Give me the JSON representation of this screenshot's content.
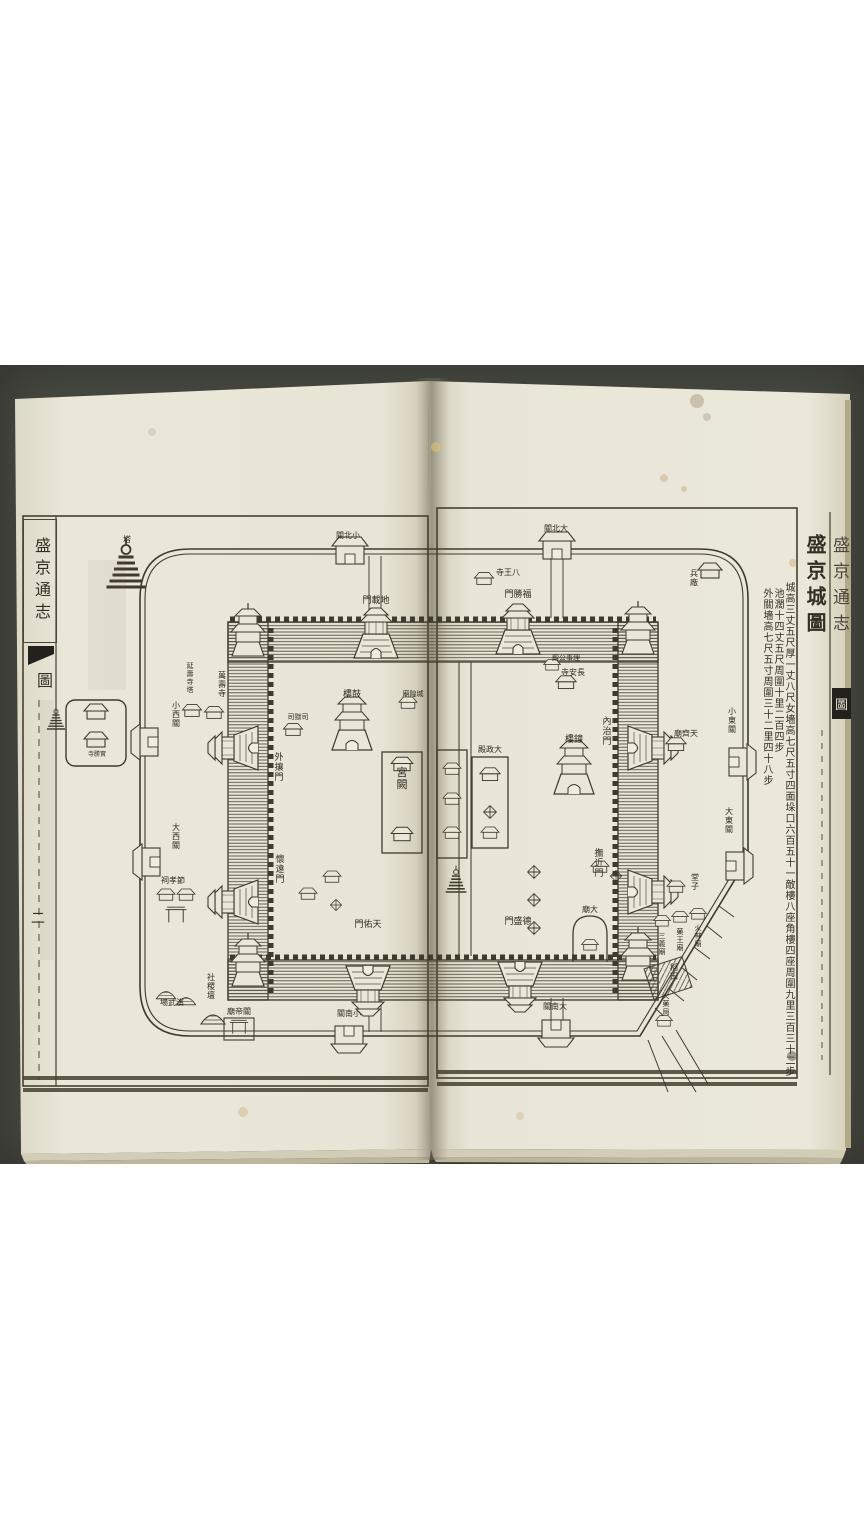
{
  "palette": {
    "background_dark": "#484b42",
    "paper": "#eae6d8",
    "ink": "#3c372b",
    "white_band": "#ffffff"
  },
  "book": {
    "map_title": "盛京城圖",
    "stats": [
      "城高三丈五尺厚一丈八尺女墻高七尺五寸四面垛口六百五十一敵樓八座角樓四座周圍九里三百三十二步",
      "池濶十四丈五尺周圍十里二百四步",
      "外關墻高七尺五寸周圍三十二里四十八步"
    ],
    "left_margin": {
      "title": "盛京通志",
      "section_tab": "圖",
      "page_number": "二"
    },
    "right_margin_partial": {
      "title": "盛京通志",
      "section_tab": "圖"
    }
  },
  "map": {
    "inner_city_gates": [
      "地載門",
      "福勝門",
      "內治門",
      "撫近門",
      "天佑門",
      "德盛門",
      "外攘門",
      "懷遠門"
    ],
    "outer_ring_gates": [
      "小北關",
      "大北關",
      "小西關",
      "大西關",
      "小東關",
      "大東關",
      "小南關",
      "大南關"
    ],
    "labels": [
      {
        "name": "gate-dizai-men",
        "text": "地載門",
        "o": "h",
        "x": 376,
        "y": 603,
        "s": 9
      },
      {
        "name": "gate-fusheng-men",
        "text": "福勝門",
        "o": "h",
        "x": 518,
        "y": 597,
        "s": 9
      },
      {
        "name": "gate-neizhi-men",
        "text": "內治門",
        "o": "v",
        "x": 607,
        "y": 724,
        "s": 9
      },
      {
        "name": "gate-fujin-men",
        "text": "撫近門",
        "o": "v",
        "x": 599,
        "y": 856,
        "s": 9
      },
      {
        "name": "gate-tianyou-men",
        "text": "天佑門",
        "o": "h",
        "x": 368,
        "y": 927,
        "s": 9
      },
      {
        "name": "gate-desheng-men",
        "text": "德盛門",
        "o": "h",
        "x": 518,
        "y": 924,
        "s": 9
      },
      {
        "name": "gate-wairang-men",
        "text": "外攘門",
        "o": "v",
        "x": 279,
        "y": 760,
        "s": 9
      },
      {
        "name": "gate-huaiyuan-men",
        "text": "懷遠門",
        "o": "v",
        "x": 280,
        "y": 862,
        "s": 9
      },
      {
        "name": "gate-xiaobei-guan",
        "text": "小北關",
        "o": "h",
        "x": 348,
        "y": 538,
        "s": 8
      },
      {
        "name": "gate-dabei-guan",
        "text": "大北關",
        "o": "h",
        "x": 556,
        "y": 531,
        "s": 8
      },
      {
        "name": "gate-xiaoxi-guan",
        "text": "小西關",
        "o": "v",
        "x": 176,
        "y": 708,
        "s": 8
      },
      {
        "name": "gate-daxi-guan",
        "text": "大西關",
        "o": "v",
        "x": 176,
        "y": 830,
        "s": 8
      },
      {
        "name": "gate-xiaodong-guan",
        "text": "小東關",
        "o": "v",
        "x": 732,
        "y": 714,
        "s": 8
      },
      {
        "name": "gate-dadong-guan",
        "text": "大東關",
        "o": "v",
        "x": 729,
        "y": 814,
        "s": 8
      },
      {
        "name": "gate-xiaonan-guan",
        "text": "小南關",
        "o": "h",
        "x": 349,
        "y": 1016,
        "s": 8
      },
      {
        "name": "gate-danan-guan",
        "text": "大南關",
        "o": "h",
        "x": 555,
        "y": 1009,
        "s": 8
      },
      {
        "name": "tower-gulou",
        "text": "鼓樓",
        "o": "h",
        "x": 352,
        "y": 697,
        "s": 9
      },
      {
        "name": "tower-zhonglou",
        "text": "鐘樓",
        "o": "h",
        "x": 574,
        "y": 742,
        "s": 9
      },
      {
        "name": "office-siyusi",
        "text": "司獄司",
        "o": "h",
        "x": 298,
        "y": 719,
        "s": 7
      },
      {
        "name": "temple-chenghuangmiao",
        "text": "城隍廟",
        "o": "h",
        "x": 413,
        "y": 696,
        "s": 7
      },
      {
        "name": "palace-gongque",
        "text": "宮闕",
        "o": "v",
        "x": 402,
        "y": 776,
        "s": 11
      },
      {
        "name": "palace-dazhengdian",
        "text": "大政殿",
        "o": "h",
        "x": 490,
        "y": 752,
        "s": 8
      },
      {
        "name": "temple-changansi",
        "text": "長安寺",
        "o": "h",
        "x": 573,
        "y": 675,
        "s": 8
      },
      {
        "name": "office-lishi-gongxie",
        "text": "理事公廨",
        "o": "h",
        "x": 566,
        "y": 660,
        "s": 7
      },
      {
        "name": "temple-tianqimiao",
        "text": "天齊廟",
        "o": "h",
        "x": 686,
        "y": 736,
        "s": 8
      },
      {
        "name": "temple-bawangsi",
        "text": "八王寺",
        "o": "h",
        "x": 508,
        "y": 575,
        "s": 8
      },
      {
        "name": "yard-bingchang",
        "text": "兵廠",
        "o": "v",
        "x": 694,
        "y": 576,
        "s": 8
      },
      {
        "name": "shrine-tangzi",
        "text": "堂子",
        "o": "v",
        "x": 695,
        "y": 880,
        "s": 8
      },
      {
        "name": "temple-sanyimiao",
        "text": "三義廟",
        "o": "v",
        "x": 662,
        "y": 938,
        "s": 7
      },
      {
        "name": "temple-yaowangmiao",
        "text": "藥王廟",
        "o": "v",
        "x": 680,
        "y": 934,
        "s": 7
      },
      {
        "name": "temple-huoshenmiao",
        "text": "火神廟",
        "o": "v",
        "x": 698,
        "y": 930,
        "s": 7
      },
      {
        "name": "field-daotian",
        "text": "稻田",
        "o": "v",
        "x": 674,
        "y": 970,
        "s": 8
      },
      {
        "name": "office-huoyaoju",
        "text": "火藥局",
        "o": "v",
        "x": 666,
        "y": 998,
        "s": 7
      },
      {
        "name": "temple-wanshousi",
        "text": "萬壽寺",
        "o": "v",
        "x": 222,
        "y": 678,
        "s": 8
      },
      {
        "name": "pagoda-yanshousita",
        "text": "延壽寺塔",
        "o": "v",
        "x": 190,
        "y": 668,
        "s": 7
      },
      {
        "name": "shrine-jiexiaoci",
        "text": "節孝祠",
        "o": "h",
        "x": 173,
        "y": 883,
        "s": 8
      },
      {
        "name": "altar-shejitan",
        "text": "社稷壇",
        "o": "v",
        "x": 211,
        "y": 980,
        "s": 8
      },
      {
        "name": "ground-yanwuchang",
        "text": "演武場",
        "o": "h",
        "x": 172,
        "y": 1005,
        "s": 8
      },
      {
        "name": "temple-guandimiao",
        "text": "關帝廟",
        "o": "h",
        "x": 239,
        "y": 1014,
        "s": 8
      },
      {
        "name": "temple-shishengsi",
        "text": "實勝寺",
        "o": "h",
        "x": 97,
        "y": 756,
        "s": 6
      },
      {
        "name": "pagoda-ta",
        "text": "塔",
        "o": "h",
        "x": 127,
        "y": 542,
        "s": 8
      },
      {
        "name": "temple-damiao",
        "text": "大廟",
        "o": "h",
        "x": 590,
        "y": 912,
        "s": 8
      }
    ]
  }
}
